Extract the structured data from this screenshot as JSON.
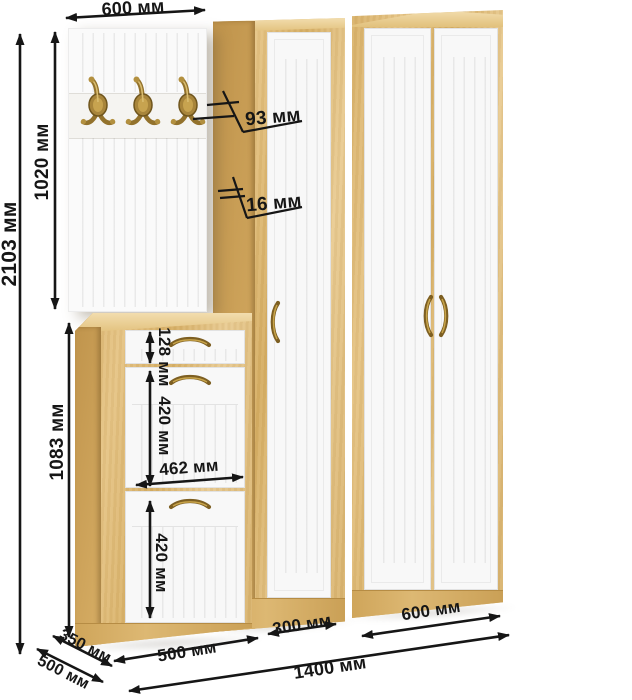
{
  "labels": {
    "panel_width": "600 мм",
    "total_height": "2103 мм",
    "panel_height": "1020 мм",
    "hook_depth": "93 мм",
    "panel_thickness": "16 мм",
    "cabinet_height": "1083 мм",
    "drawer_height": "128 мм",
    "flap1_height": "420 мм",
    "front_width": "462 мм",
    "flap2_height": "420 мм",
    "cabinet_depth": "350 мм",
    "wardrobe_depth": "500 мм",
    "cabinet_width": "500 мм",
    "narrow_wardrobe_width": "300 мм",
    "wide_wardrobe_width": "600 мм",
    "total_width": "1400 мм"
  },
  "colors": {
    "dim_line": "#161616",
    "oak_base": "#d9b26a",
    "oak_top": "#ecd3a0",
    "oak_side": "#c79e58",
    "front_white": "#f8f8f8",
    "brass": "#93722c"
  }
}
